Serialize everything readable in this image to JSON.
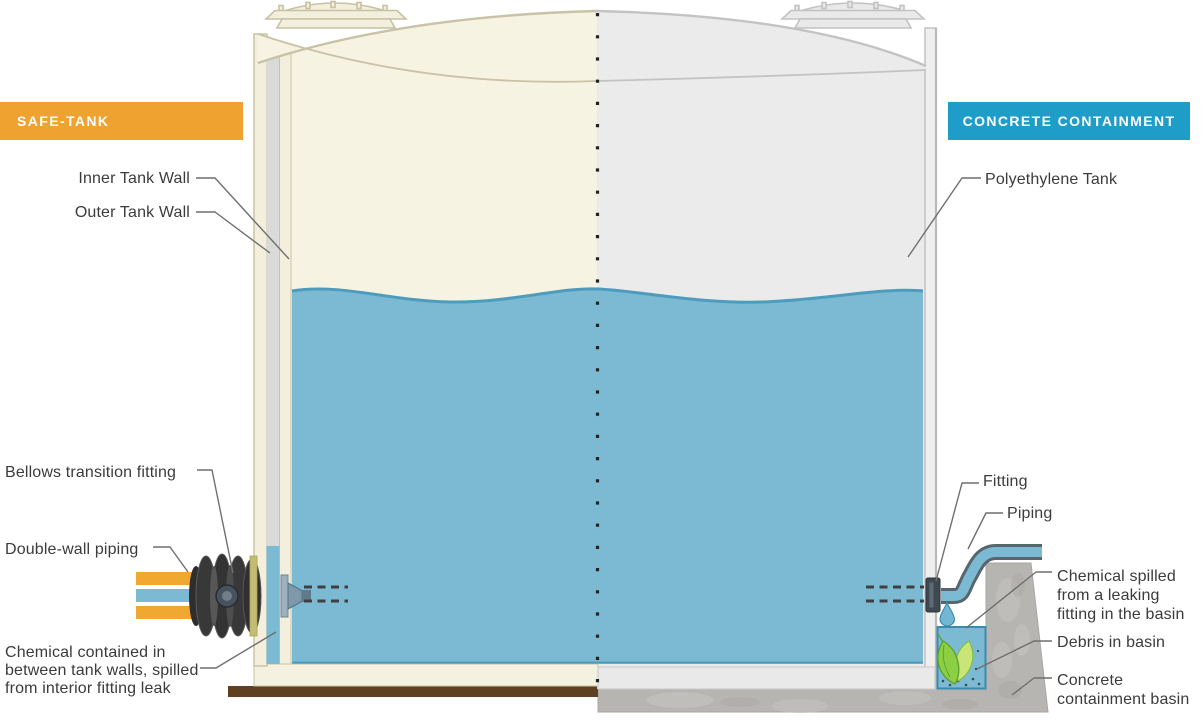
{
  "header": {
    "left_banner": "SAFE-TANK",
    "right_banner": "CONCRETE CONTAINMENT"
  },
  "safe_tank_labels": {
    "inner_wall": "Inner Tank Wall",
    "outer_wall": "Outer Tank Wall",
    "bellows": "Bellows transition fitting",
    "piping": "Double-wall piping",
    "chemical": "Chemical contained in\nbetween tank walls, spilled\nfrom interior fitting leak"
  },
  "containment_labels": {
    "tank": "Polyethylene Tank",
    "fitting": "Fitting",
    "piping": "Piping",
    "chemical": "Chemical spilled\nfrom a leaking\nfitting in the basin",
    "debris": "Debris in basin",
    "basin": "Concrete\ncontainment basin"
  },
  "colors": {
    "safe_tank_orange": "#F0A230",
    "containment_teal": "#1F9DC9",
    "chemical_blue": "#7CBAD3",
    "tank_cream": "#F7F3E2",
    "tank_gray": "#EBEBEB",
    "concrete_gray": "#B7B5B2",
    "base_brown": "#5E4120",
    "debris_green": "#8CCF45"
  }
}
